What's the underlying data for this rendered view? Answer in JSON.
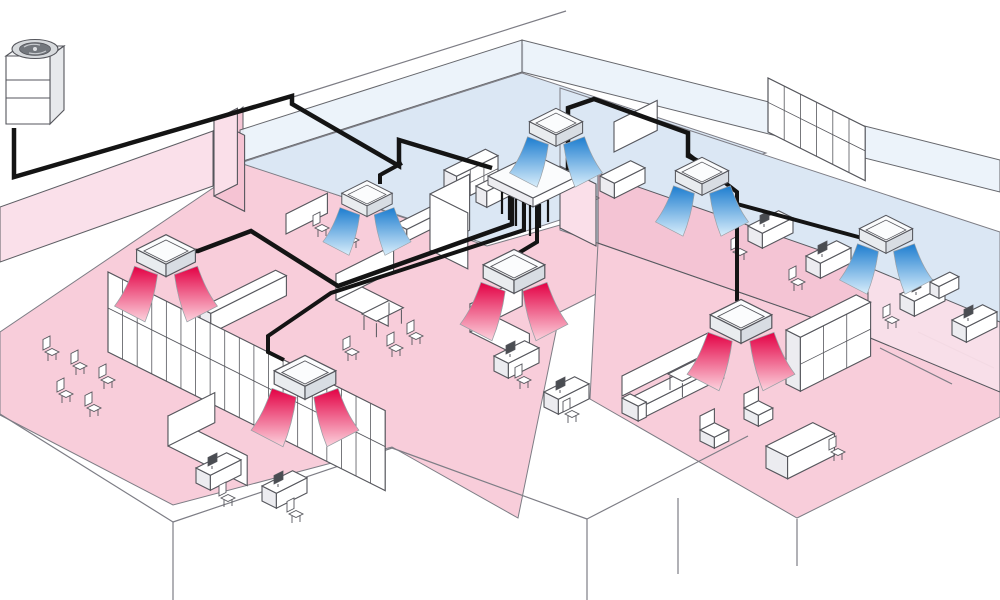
{
  "diagram": {
    "kind": "isometric-cutaway",
    "subject": "multi-zone office air-conditioning system",
    "outdoor_unit_count": 1,
    "indoor_unit_count": 8,
    "heating_unit_count": 4,
    "cooling_unit_count": 4
  },
  "colors": {
    "pipe": "#141414",
    "outline": "#55565c",
    "edge": "#7d7d85",
    "floor_heating": "#f8cdda",
    "floor_cooling": "#dbe7f4",
    "wall_heating": "#fadfe9",
    "wall_heating_strong": "#f5c3d3",
    "wall_cooling": "#eaf2fa",
    "unit_top": "#fbfcfd",
    "unit_side_l": "#e9ecef",
    "unit_side_r": "#d8dde3",
    "flow_heat_hi": "#e30044",
    "flow_heat_lo": "#fcd3de",
    "flow_cool_hi": "#1d7dcf",
    "flow_cool_lo": "#d9eefb",
    "fan_dark": "#73777d",
    "fan_light": "#d7dadd",
    "furn_fill": "#ffffff",
    "furn_shade": "#ececf0",
    "monitor": "#4a4d52"
  },
  "outdoor_unit": {
    "id": "ou1",
    "x": 6,
    "y": 22
  },
  "branch_box": {
    "top": "488,176 533,154 578,176 533,198",
    "face_l": "488,176 533,198 533,207 488,185",
    "face_r": "578,176 533,198 533,207 578,185",
    "stubs": [
      "502,192 502,214",
      "509,196 509,220",
      "516,199 516,226",
      "523,202 523,230",
      "530,205 530,236",
      "540,204 540,228",
      "548,200 548,222"
    ]
  },
  "zones": [
    {
      "id": "open-office-west",
      "mode": "heating",
      "points": "0,332 213,188 243,163 487,246 560,225 600,244 620,282 560,312 518,518 392,447 173,505 0,415"
    },
    {
      "id": "executive-room-south",
      "mode": "heating",
      "points": "598,243 868,337 1000,390 1000,417 797,518 590,399"
    },
    {
      "id": "meeting-room-north",
      "mode": "cooling",
      "points": "240,163 522,73 766,153 486,244"
    },
    {
      "id": "open-area-east",
      "mode": "cooling",
      "points": "560,88 1000,232 1000,392 868,337 560,230"
    }
  ],
  "walls": [
    {
      "id": "pink-back-west",
      "points": "0,262 213,186 213,131 0,207",
      "fill": "wall_heating",
      "op": 0.95
    },
    {
      "id": "pink-back-west-2",
      "points": "213,186 243,162 243,107 213,131",
      "fill": "wall_heating_strong",
      "op": 0.95
    },
    {
      "id": "glass-back-north",
      "points": "240,162 522,72 522,40 240,130",
      "fill": "wall_cooling",
      "op": 0.9
    },
    {
      "id": "glass-back-east",
      "points": "522,72 1000,192 1000,160 522,40",
      "fill": "wall_cooling",
      "op": 0.9
    },
    {
      "id": "exec-back-wall",
      "points": "598,243 868,337 868,267 598,173",
      "fill": "wall_heating_strong",
      "op": 0.97
    },
    {
      "id": "exec-right-wall",
      "points": "868,337 1000,392 1000,322 868,267",
      "fill": "wall_heating",
      "op": 0.95
    }
  ],
  "edges": [
    "293,97 566,11",
    "523,44 523,72",
    "0,414 173,522",
    "173,522 173,600",
    "173,522 392,448",
    "392,448 587,519",
    "587,519 587,600",
    "587,519 748,436",
    "678,498 678,574",
    "797,519 797,566",
    "880,348 952,384",
    "918,332 994,368"
  ],
  "pipes": [
    {
      "id": "main-line",
      "w": 4.5,
      "pts": "14,128 14,177 292,96 292,104 399,166 399,140 492,168"
    },
    {
      "id": "branch-cassette-b1",
      "w": 4,
      "pts": "402,163 380,175 380,184"
    },
    {
      "id": "branch-upper-east",
      "w": 4.5,
      "pts": "568,170 568,108 594,99 688,133 688,156 700,162"
    },
    {
      "id": "branch-cassette-b4",
      "w": 4,
      "pts": "688,154 737,192 737,204 862,238"
    },
    {
      "id": "branch-exec-room",
      "w": 4,
      "pts": "737,198 737,300 741,306"
    },
    {
      "id": "branch-west-heating",
      "w": 4.5,
      "pts": "512,194 512,224 338,286 251,231 198,251 176,251"
    },
    {
      "id": "branch-front-heating",
      "w": 4,
      "pts": "524,197 524,230 331,293 268,336 268,352 284,360"
    },
    {
      "id": "branch-center-heating",
      "w": 4,
      "pts": "537,199 537,242 517,254"
    }
  ],
  "indoor_units": [
    {
      "id": "r1",
      "mode": "heating",
      "x": 166,
      "y": 262,
      "s": 1.05
    },
    {
      "id": "r2",
      "mode": "heating",
      "x": 305,
      "y": 384,
      "s": 1.1
    },
    {
      "id": "r3",
      "mode": "heating",
      "x": 514,
      "y": 278,
      "s": 1.1
    },
    {
      "id": "r4",
      "mode": "heating",
      "x": 741,
      "y": 328,
      "s": 1.1
    },
    {
      "id": "b1",
      "mode": "cooling",
      "x": 367,
      "y": 204,
      "s": 0.9
    },
    {
      "id": "b2",
      "mode": "cooling",
      "x": 556,
      "y": 133,
      "s": 0.95
    },
    {
      "id": "b3",
      "mode": "cooling",
      "x": 702,
      "y": 182,
      "s": 0.95
    },
    {
      "id": "b4",
      "mode": "cooling",
      "x": 886,
      "y": 240,
      "s": 0.95
    }
  ],
  "furniture": [
    {
      "t": "chair",
      "x": 52,
      "y": 352
    },
    {
      "t": "chair",
      "x": 80,
      "y": 366
    },
    {
      "t": "chair",
      "x": 108,
      "y": 380
    },
    {
      "t": "chair",
      "x": 66,
      "y": 394
    },
    {
      "t": "chair",
      "x": 94,
      "y": 408
    },
    {
      "t": "box",
      "x": 200,
      "y": 308,
      "a": 12,
      "b": 84,
      "h": 20
    },
    {
      "t": "glassA",
      "x": 108,
      "y": 352,
      "a": 308,
      "h": 80
    },
    {
      "t": "panelA",
      "x": 214,
      "y": 196,
      "a": 34,
      "h": 76,
      "fill": "wall_heating_strong"
    },
    {
      "t": "panel",
      "x": 214,
      "y": 196,
      "b": 26,
      "h": 76,
      "fill": "wall_heating"
    },
    {
      "t": "panel",
      "x": 286,
      "y": 234,
      "b": 46,
      "h": 20
    },
    {
      "t": "box",
      "x": 396,
      "y": 224,
      "a": 12,
      "b": 42,
      "h": 12
    },
    {
      "t": "chair",
      "x": 322,
      "y": 228
    },
    {
      "t": "chair",
      "x": 352,
      "y": 240
    },
    {
      "t": "shelf",
      "x": 444,
      "y": 170,
      "a": 14,
      "b": 46,
      "h": 26
    },
    {
      "t": "box",
      "x": 476,
      "y": 186,
      "a": 12,
      "b": 36,
      "h": 16
    },
    {
      "t": "desk",
      "x": 600,
      "y": 176
    },
    {
      "t": "chair",
      "x": 592,
      "y": 198
    },
    {
      "t": "panel",
      "x": 614,
      "y": 152,
      "b": 48,
      "h": 30
    },
    {
      "t": "glassA",
      "x": 768,
      "y": 132,
      "a": 108,
      "h": 54
    },
    {
      "t": "desk",
      "x": 748,
      "y": 226,
      "m": 1
    },
    {
      "t": "chair",
      "x": 740,
      "y": 252
    },
    {
      "t": "desk",
      "x": 806,
      "y": 256,
      "m": 1
    },
    {
      "t": "chair",
      "x": 798,
      "y": 282
    },
    {
      "t": "desk",
      "x": 900,
      "y": 294,
      "m": 1
    },
    {
      "t": "chair",
      "x": 892,
      "y": 320
    },
    {
      "t": "desk",
      "x": 952,
      "y": 320,
      "m": 1
    },
    {
      "t": "box",
      "x": 930,
      "y": 282,
      "a": 10,
      "b": 22,
      "h": 12
    },
    {
      "t": "panelA",
      "x": 336,
      "y": 300,
      "a": 58,
      "h": 26
    },
    {
      "t": "panel",
      "x": 336,
      "y": 300,
      "b": 64,
      "h": 26
    },
    {
      "t": "table",
      "x": 362,
      "y": 330
    },
    {
      "t": "chair",
      "x": 352,
      "y": 352
    },
    {
      "t": "chair",
      "x": 396,
      "y": 348
    },
    {
      "t": "chair",
      "x": 416,
      "y": 336
    },
    {
      "t": "panelA",
      "x": 470,
      "y": 332,
      "a": 66,
      "h": 28
    },
    {
      "t": "panel",
      "x": 470,
      "y": 332,
      "b": 58,
      "h": 28
    },
    {
      "t": "desk",
      "x": 494,
      "y": 356,
      "m": 1
    },
    {
      "t": "chair",
      "x": 524,
      "y": 380
    },
    {
      "t": "desk",
      "x": 544,
      "y": 392,
      "m": 1
    },
    {
      "t": "chair",
      "x": 572,
      "y": 414
    },
    {
      "t": "panelA",
      "x": 168,
      "y": 446,
      "a": 88,
      "h": 30
    },
    {
      "t": "panel",
      "x": 168,
      "y": 446,
      "b": 52,
      "h": 30
    },
    {
      "t": "desk",
      "x": 196,
      "y": 468,
      "m": 1
    },
    {
      "t": "chair",
      "x": 228,
      "y": 498
    },
    {
      "t": "desk",
      "x": 262,
      "y": 486,
      "m": 1
    },
    {
      "t": "chair",
      "x": 296,
      "y": 514
    },
    {
      "t": "panel",
      "x": 430,
      "y": 250,
      "b": 44,
      "h": 56,
      "fill": "furn_fill"
    },
    {
      "t": "panelA",
      "x": 430,
      "y": 250,
      "a": 42,
      "h": 56,
      "fill": "furn_fill"
    },
    {
      "t": "panelA",
      "x": 560,
      "y": 228,
      "a": 40,
      "h": 62,
      "fill": "wall_heating"
    },
    {
      "t": "sofa",
      "x": 622,
      "y": 396,
      "b": 96
    },
    {
      "t": "table",
      "x": 668,
      "y": 390
    },
    {
      "t": "chair2",
      "x": 700,
      "y": 430
    },
    {
      "t": "chair2",
      "x": 744,
      "y": 408
    },
    {
      "t": "box",
      "x": 766,
      "y": 446,
      "a": 24,
      "b": 52,
      "h": 22
    },
    {
      "t": "chair",
      "x": 838,
      "y": 452
    },
    {
      "t": "shelf",
      "x": 786,
      "y": 330,
      "a": 16,
      "b": 78,
      "h": 54
    }
  ]
}
